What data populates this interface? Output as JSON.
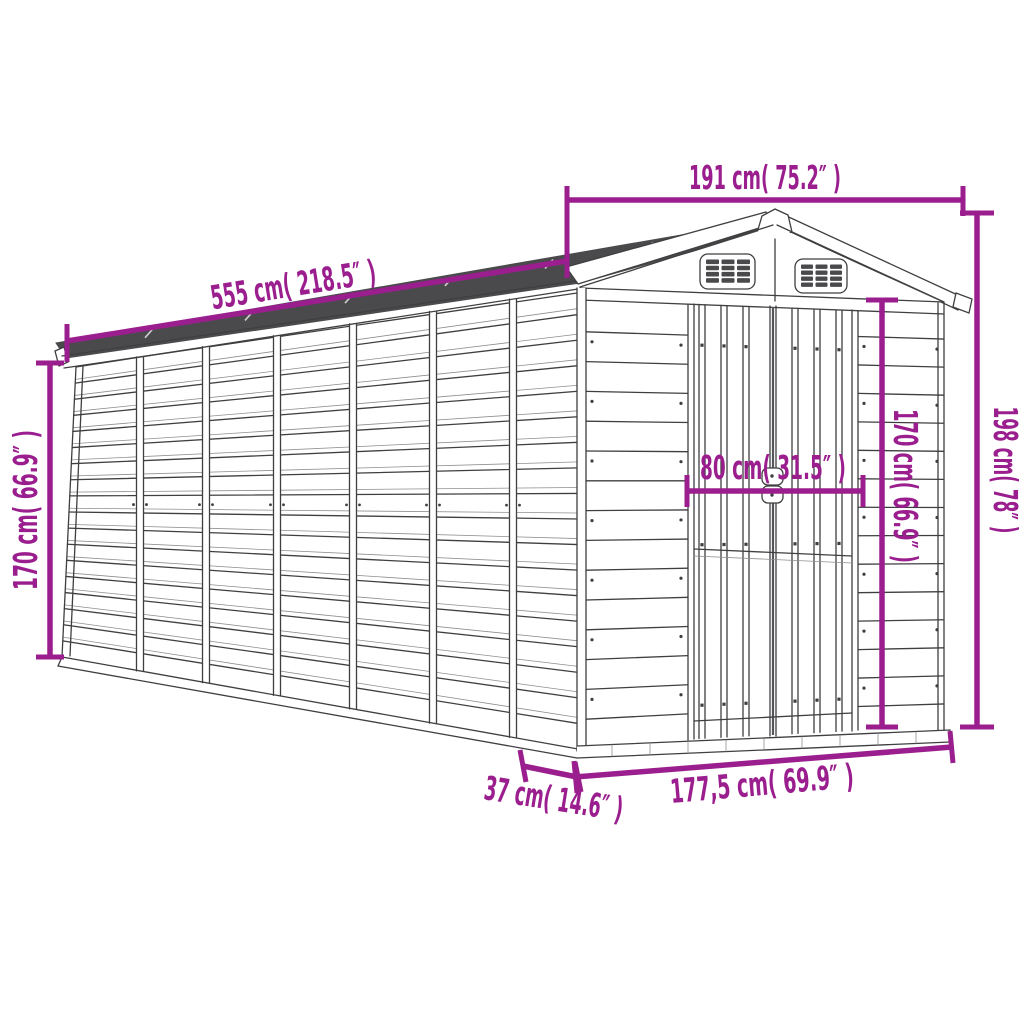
{
  "colors": {
    "dimension_accent": "#9B1E8E",
    "line_art": "#3F3F41",
    "roof_shade": "#4A4A4D",
    "background": "#FFFFFF"
  },
  "subject": "garden shed line drawing with apex roof, two gable vents and double doors",
  "dimensions": {
    "roof_width_front": {
      "label": "191 cm( 75.2″ )",
      "cm": "191",
      "inches": "75.2",
      "orientation": "horizontal-top"
    },
    "roof_length_side": {
      "label": "555 cm( 218.5″ )",
      "cm": "555",
      "inches": "218.5",
      "orientation": "sloped-roof"
    },
    "wall_height_left": {
      "label": "170 cm( 66.9″ )",
      "cm": "170",
      "inches": "66.9",
      "orientation": "vertical-left"
    },
    "door_width": {
      "label": "80 cm( 31.5″ )",
      "cm": "80",
      "inches": "31.5",
      "orientation": "horizontal-door"
    },
    "door_height": {
      "label": "170 cm( 66.9″ )",
      "cm": "170",
      "inches": "66.9",
      "orientation": "vertical-door"
    },
    "overall_height": {
      "label": "198 cm( 78″ )",
      "cm": "198",
      "inches": "78",
      "orientation": "vertical-right"
    },
    "front_base_width": {
      "label": "177,5 cm( 69.9″ )",
      "cm": "177,5",
      "inches": "69.9",
      "orientation": "horizontal-base"
    },
    "side_base_offset": {
      "label": "37 cm( 14.6″ )",
      "cm": "37",
      "inches": "14.6",
      "orientation": "horizontal-base-left"
    }
  }
}
